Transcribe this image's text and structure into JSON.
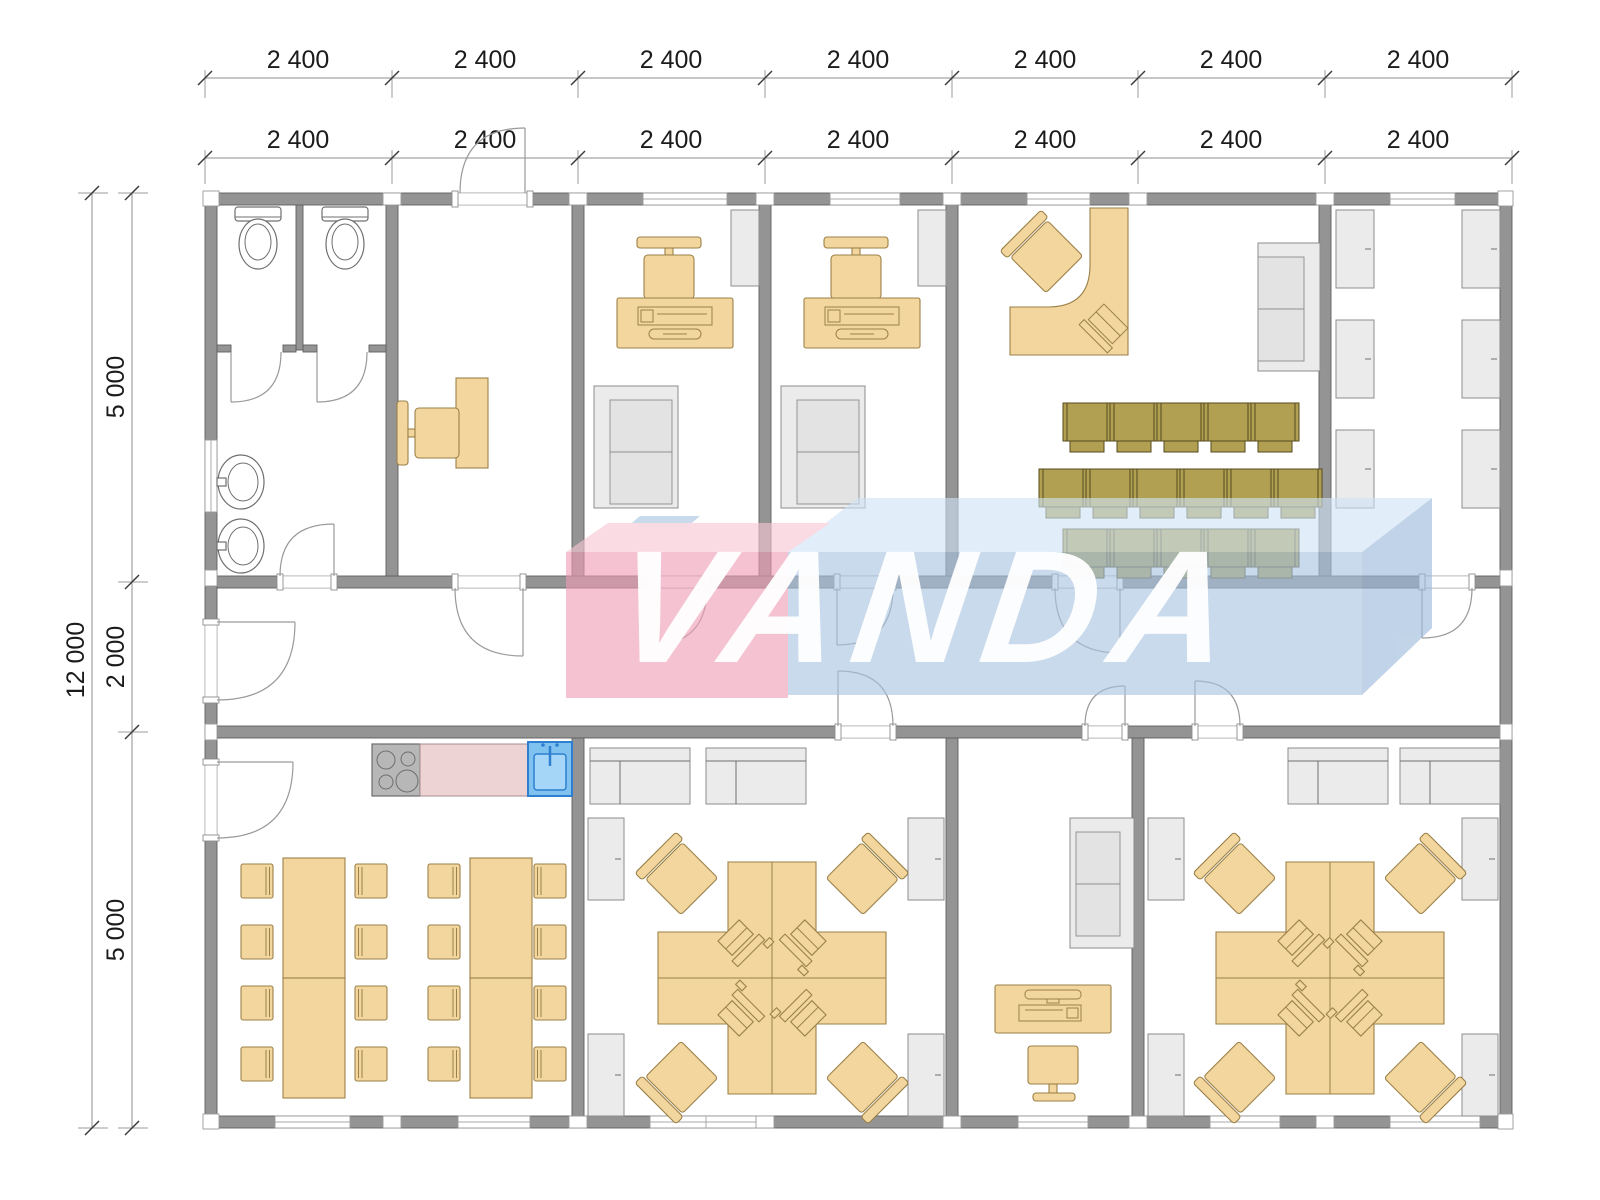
{
  "watermark": {
    "text": "VANDA"
  },
  "dimensions": {
    "top_row1": [
      "2 400",
      "2 400",
      "2 400",
      "2 400",
      "2 400",
      "2 400",
      "2 400"
    ],
    "top_row2": [
      "2 400",
      "2 400",
      "2 400",
      "2 400",
      "2 400",
      "2 400",
      "2 400"
    ],
    "left_total": "12 000",
    "left_segments": [
      "5 000",
      "2 000",
      "5 000"
    ]
  },
  "colors": {
    "wall": "#949494",
    "wall_stroke": "#5f5f5f",
    "furn": "#f3d59e",
    "furn_stroke": "#9a8148",
    "olive": "#b1a052",
    "olive_stroke": "#554a1e",
    "gray_furn": "#ebebeb",
    "gray_furn_stroke": "#8c8c8c",
    "counter_pink": "#edd3d3",
    "counter_pink_stroke": "#a88d8d",
    "sink_blue": "#7fc2f0",
    "sink_blue_dark": "#2f7fd1",
    "sink_basin": "#a5d6f7",
    "stove_gray": "#b7b7b7",
    "stove_stroke": "#6c6c6c",
    "wm_pink_front": "#ef9db5",
    "wm_pink_top": "#f7c6d4",
    "wm_blue_front": "#a8c4e2",
    "wm_blue_top": "#cfe3f6",
    "wm_blue_side": "#9cb9da",
    "dim_text": "#1b1b1b"
  },
  "icons": {
    "toilet-icon": "toilet plan symbol",
    "washbasin-icon": "wash basin plan symbol",
    "office-chair-icon": "chair with backrest",
    "desk-computer-icon": "keyboard and mouse on desk",
    "laptop-workstation-icon": "laptop with keyboard",
    "sofa-icon": "two-seat sofa",
    "cabinet-icon": "storage cabinet",
    "stove-icon": "4-burner stove",
    "kitchen-sink-icon": "kitchen sink",
    "dining-chair-icon": "dining chair",
    "meeting-chair-icon": "audience chair"
  },
  "furniture_summary": {
    "wc_toilets": 2,
    "washbasins": 2,
    "private_offices": 2,
    "meeting_chair_rows": [
      5,
      6,
      5
    ],
    "storage_cabinets": 6,
    "dining_tables": 2,
    "dining_seats_per_table": 8,
    "workstation_clusters": 2,
    "desks_per_cluster": 4
  }
}
